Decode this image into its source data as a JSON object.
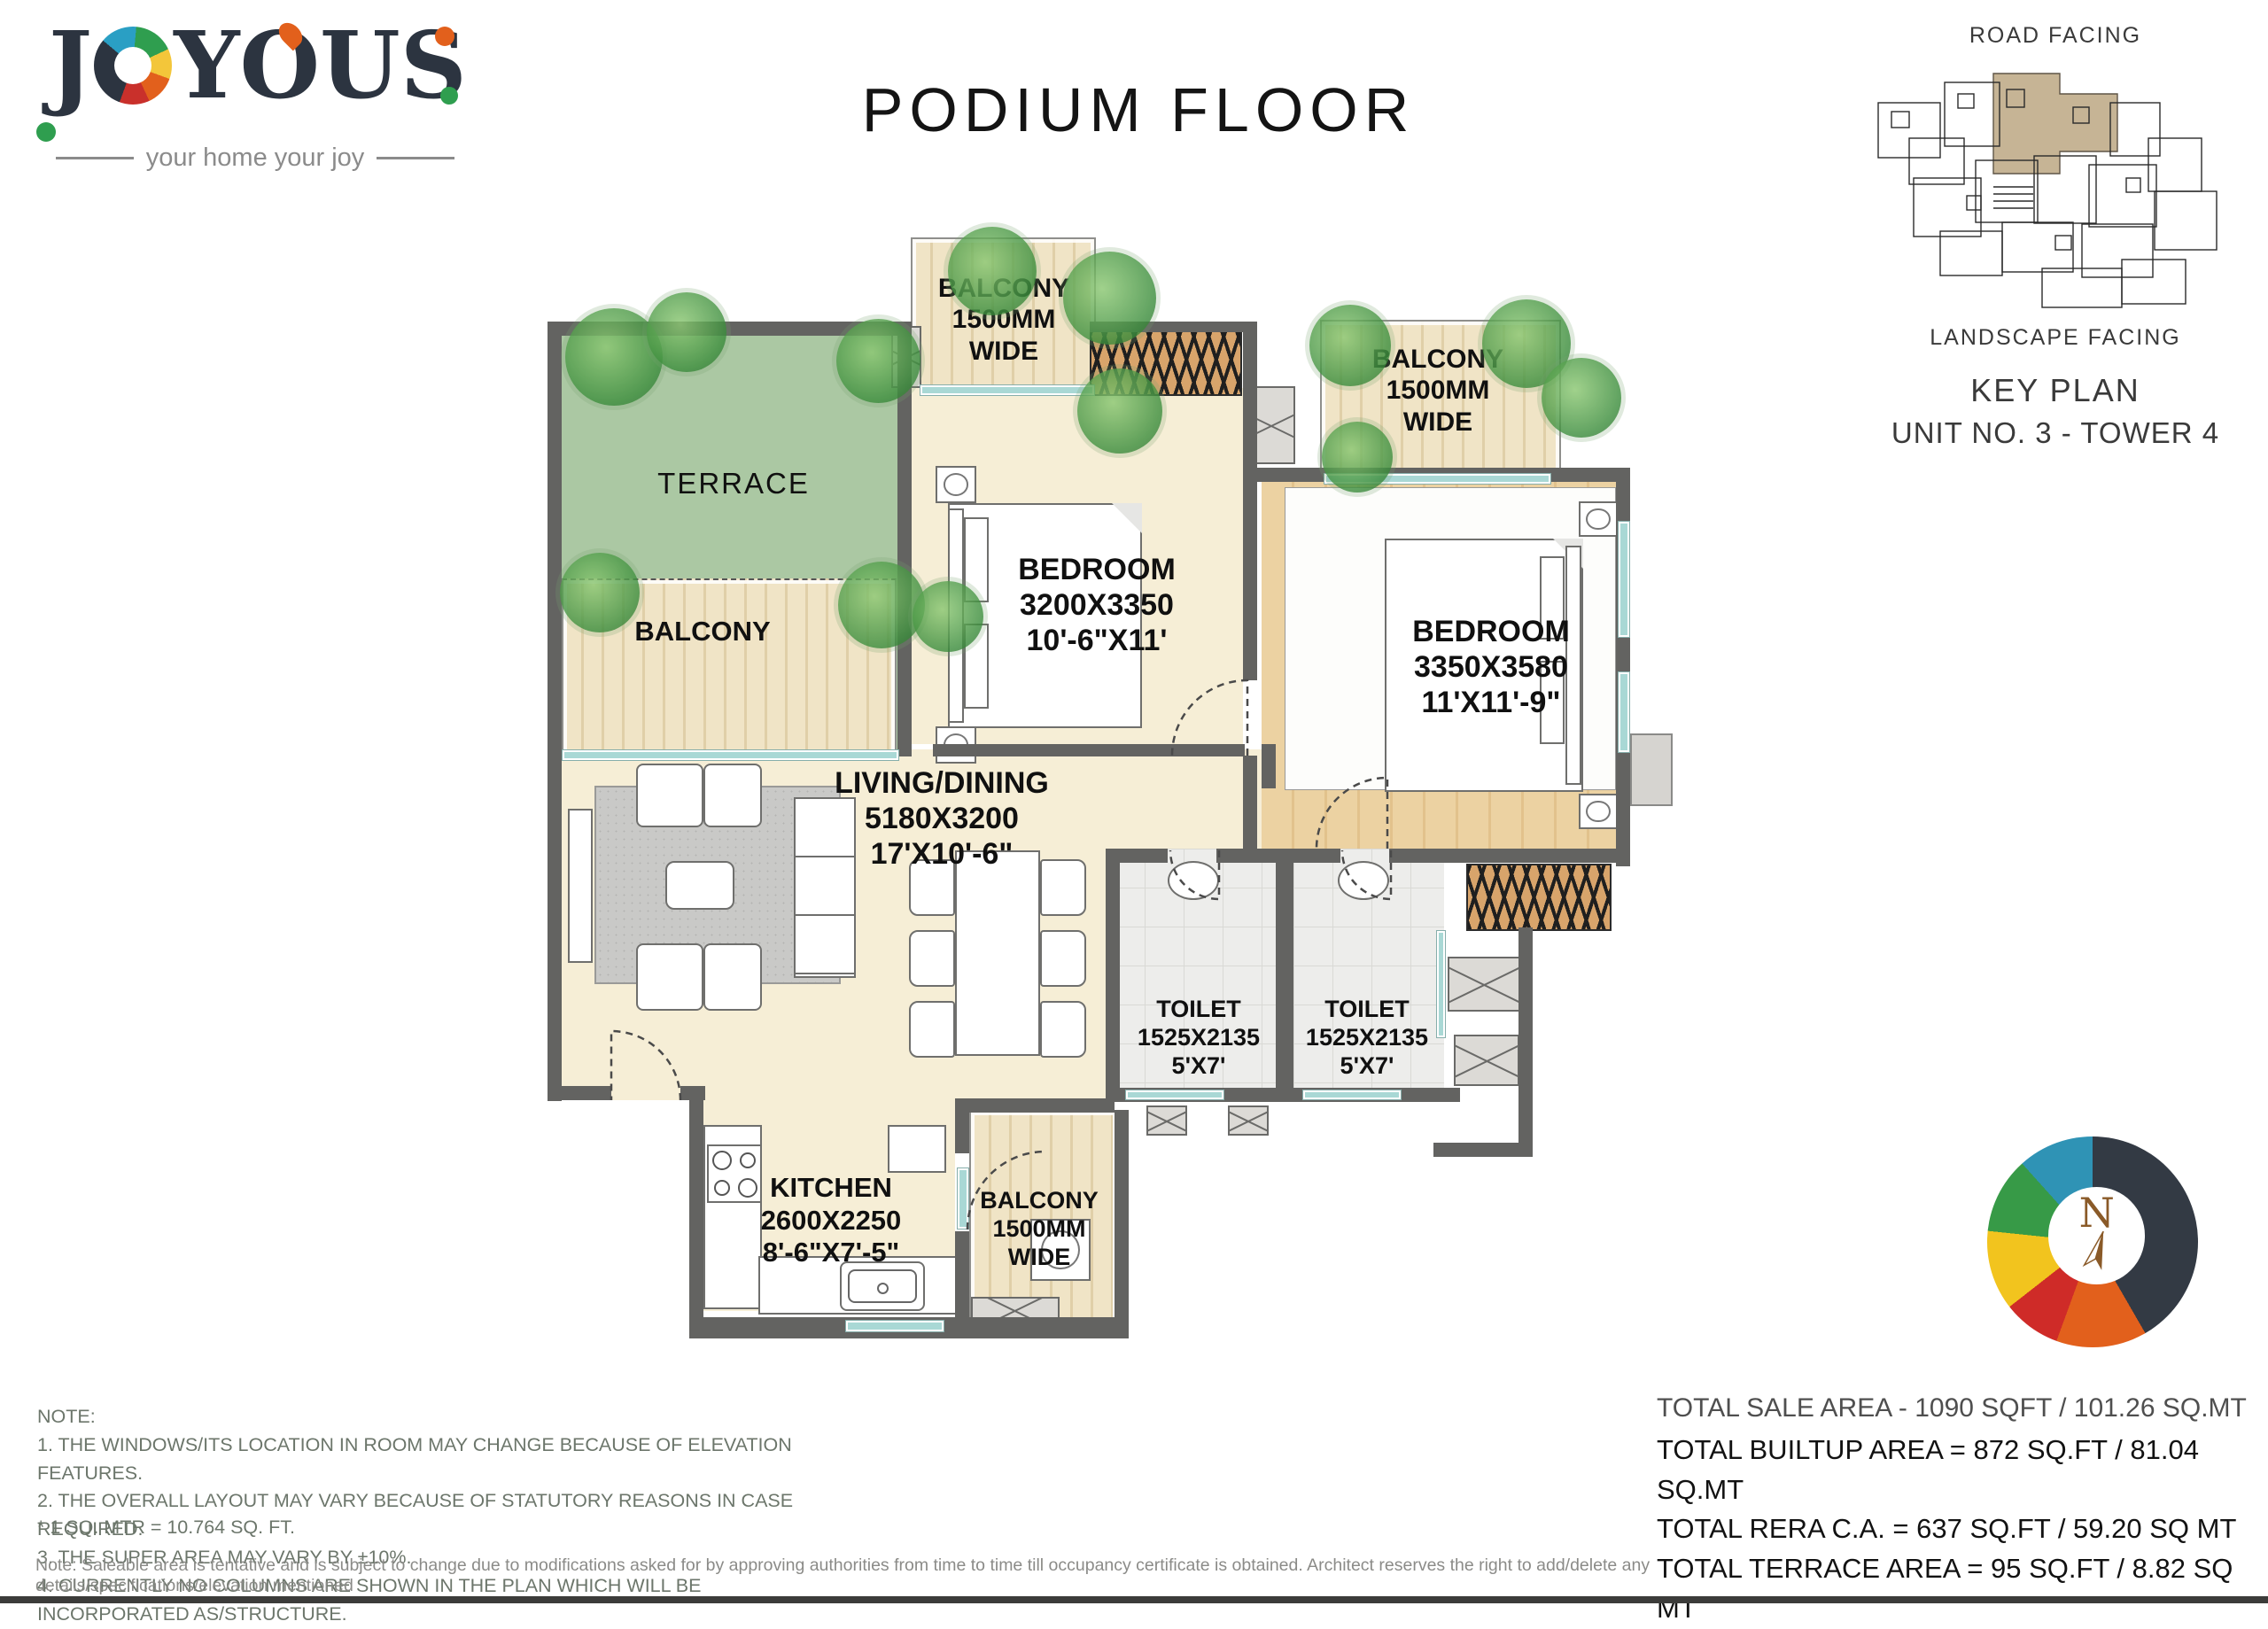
{
  "brand": {
    "name": "JOYOUS",
    "tagline": "your home your joy"
  },
  "title": "PODIUM FLOOR",
  "key_plan": {
    "top_label": "ROAD FACING",
    "bottom_label": "LANDSCAPE FACING",
    "heading": "KEY PLAN",
    "unit": "UNIT NO. 3 - TOWER 4"
  },
  "compass": {
    "north": "N"
  },
  "rooms": {
    "terrace": {
      "name": "TERRACE"
    },
    "balcony_left": {
      "name": "BALCONY"
    },
    "balcony_top": {
      "l1": "BALCONY",
      "l2": "1500MM",
      "l3": "WIDE"
    },
    "balcony_right": {
      "l1": "BALCONY",
      "l2": "1500MM",
      "l3": "WIDE"
    },
    "balcony_bottom": {
      "l1": "BALCONY",
      "l2": "1500MM",
      "l3": "WIDE"
    },
    "bedroom1": {
      "name": "BEDROOM",
      "mm": "3200X3350",
      "ft": "10'-6\"X11'"
    },
    "bedroom2": {
      "name": "BEDROOM",
      "mm": "3350X3580",
      "ft": "11'X11'-9\""
    },
    "living": {
      "name": "LIVING/DINING",
      "mm": "5180X3200",
      "ft": "17'X10'-6\""
    },
    "toilet1": {
      "name": "TOILET",
      "mm": "1525X2135",
      "ft": "5'X7'"
    },
    "toilet2": {
      "name": "TOILET",
      "mm": "1525X2135",
      "ft": "5'X7'"
    },
    "kitchen": {
      "name": "KITCHEN",
      "mm": "2600X2250",
      "ft": "8'-6\"X7'-5\""
    }
  },
  "areas": {
    "sale": "TOTAL SALE AREA - 1090 SQFT / 101.26 SQ.MT",
    "builtup": "TOTAL BUILTUP AREA = 872 SQ.FT / 81.04 SQ.MT",
    "rera": "TOTAL RERA C.A. = 637 SQ.FT / 59.20 SQ MT",
    "terrace": "TOTAL TERRACE AREA = 95 SQ.FT / 8.82 SQ MT"
  },
  "notes": {
    "heading": "NOTE:",
    "items": [
      "1. THE WINDOWS/ITS LOCATION IN ROOM MAY CHANGE BECAUSE OF ELEVATION FEATURES.",
      "2. THE OVERALL LAYOUT MAY VARY BECAUSE OF STATUTORY REASONS IN CASE REQUIRED.",
      "3. THE SUPER AREA MAY VARY BY ±10%.",
      "4. CURRENTLY NO COLUMNS ARE SHOWN IN THE PLAN WHICH WILL BE INCORPORATED AS/STRUCTURE."
    ],
    "conversion": "* 1 SQ. MTR = 10.764 SQ. FT.",
    "disclaimer": "Note: Saleable area is tentative and is subject to change due to modifications asked for by approving authorities from time to time till occupancy certificate is obtained. Architect reserves the right to add/delete any details/specifications/elevation mentioned"
  },
  "colors": {
    "wall": "#636361",
    "floor": "#f6eed6",
    "terrace_green": "#abc8a3",
    "wood": "#ecd2a2",
    "balcony": "#f0e4c6",
    "tile": "#ededeb",
    "brand_navy": "#2c3440",
    "accent_orange": "#e2601c",
    "accent_green": "#2f9e4f"
  }
}
